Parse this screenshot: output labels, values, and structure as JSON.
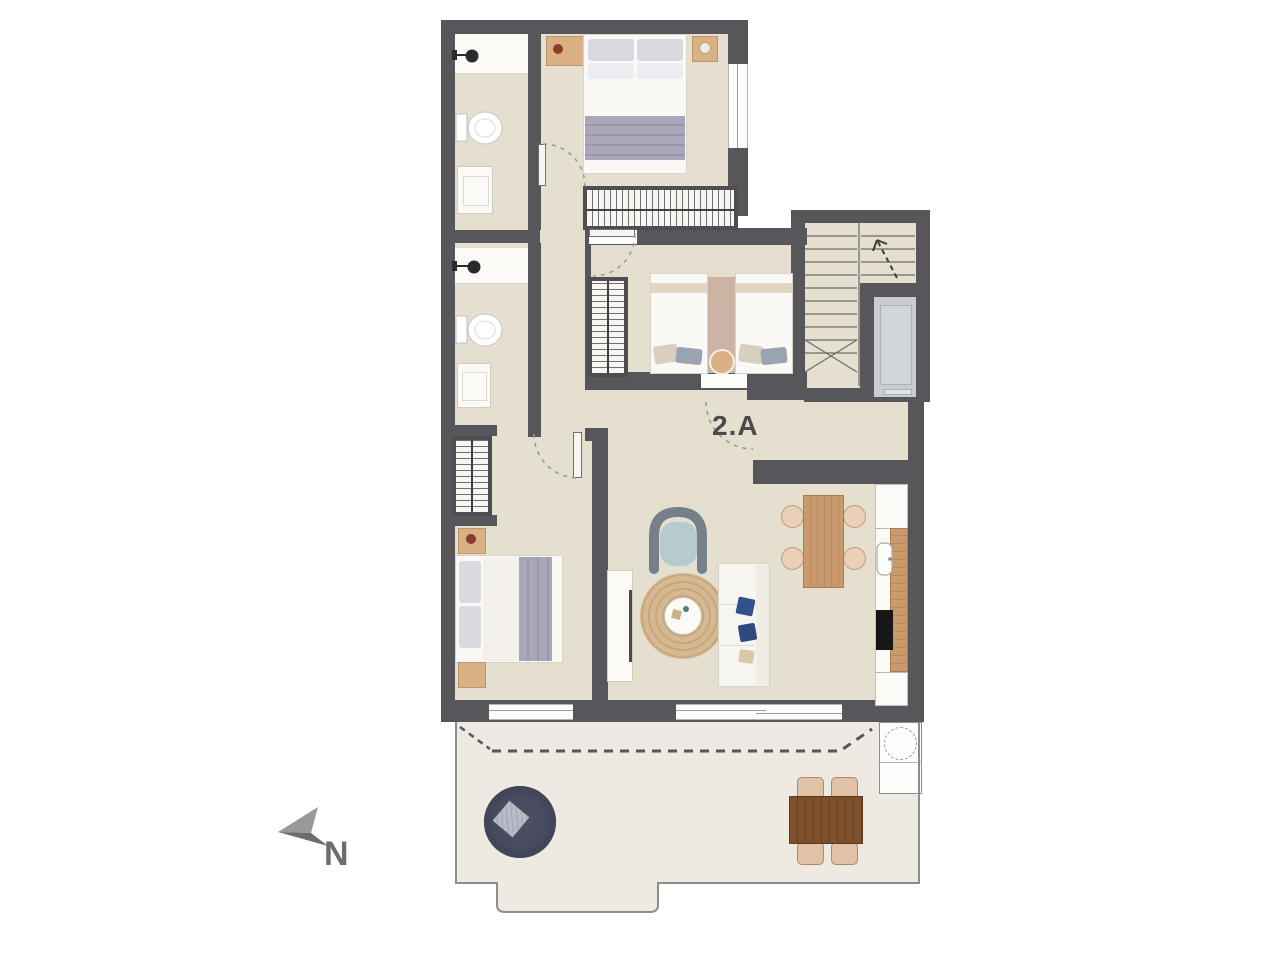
{
  "page": {
    "type": "architectural-floor-plan",
    "background": "#ffffff"
  },
  "labels": {
    "unit_label": "2.A",
    "north_label": "N"
  },
  "icons": {
    "compass": "north-arrow-icon",
    "shower": "shower-head-icon",
    "toilet": "toilet-icon",
    "sink": "sink-icon",
    "stairs": "staircase-icon",
    "elevator": "elevator-icon",
    "door": "door-swing-arc-icon",
    "wardrobe": "wardrobe-hatch-icon",
    "window": "window-icon"
  },
  "colors": {
    "wall": "#57565b",
    "floor": "#e5dfd0",
    "terrace_floor": "#eeeae1",
    "wood": "#c89a6e",
    "dark_wood": "#7d4f2c",
    "navy_daybed": "#4a4e63",
    "jute_rug": "#d3b58f",
    "blanket": "#aba7b9",
    "armchair_seat": "#b7cacf",
    "pillow_blue": "#33518a",
    "elevator_cab": "#c9cdd2",
    "label_text": "#4a4a4c"
  }
}
